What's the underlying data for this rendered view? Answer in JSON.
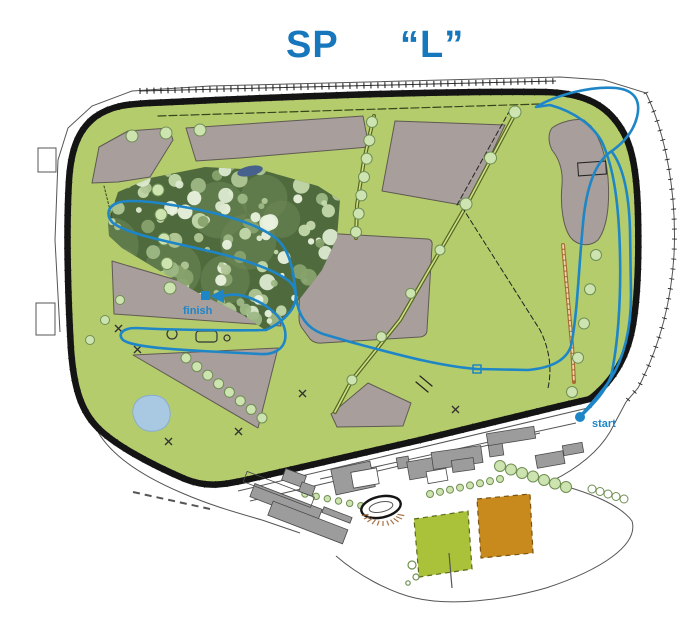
{
  "title": {
    "part1": "SP",
    "part2": "“L”"
  },
  "map": {
    "labels": {
      "start": "start",
      "finish": "finish"
    },
    "colors": {
      "title_blue": "#1777bd",
      "route_blue": "#1e86c7",
      "field_green": "#b5cc6d",
      "forest_green": "#4f6b3e",
      "area_gray": "#a89e9c",
      "building_gray": "#9c9c9c",
      "border_black": "#141414",
      "pond_light_blue": "#a9c8e2",
      "pond_dark_blue": "#46618c",
      "square_green": "#a9c23a",
      "square_orange": "#c8891d"
    }
  }
}
